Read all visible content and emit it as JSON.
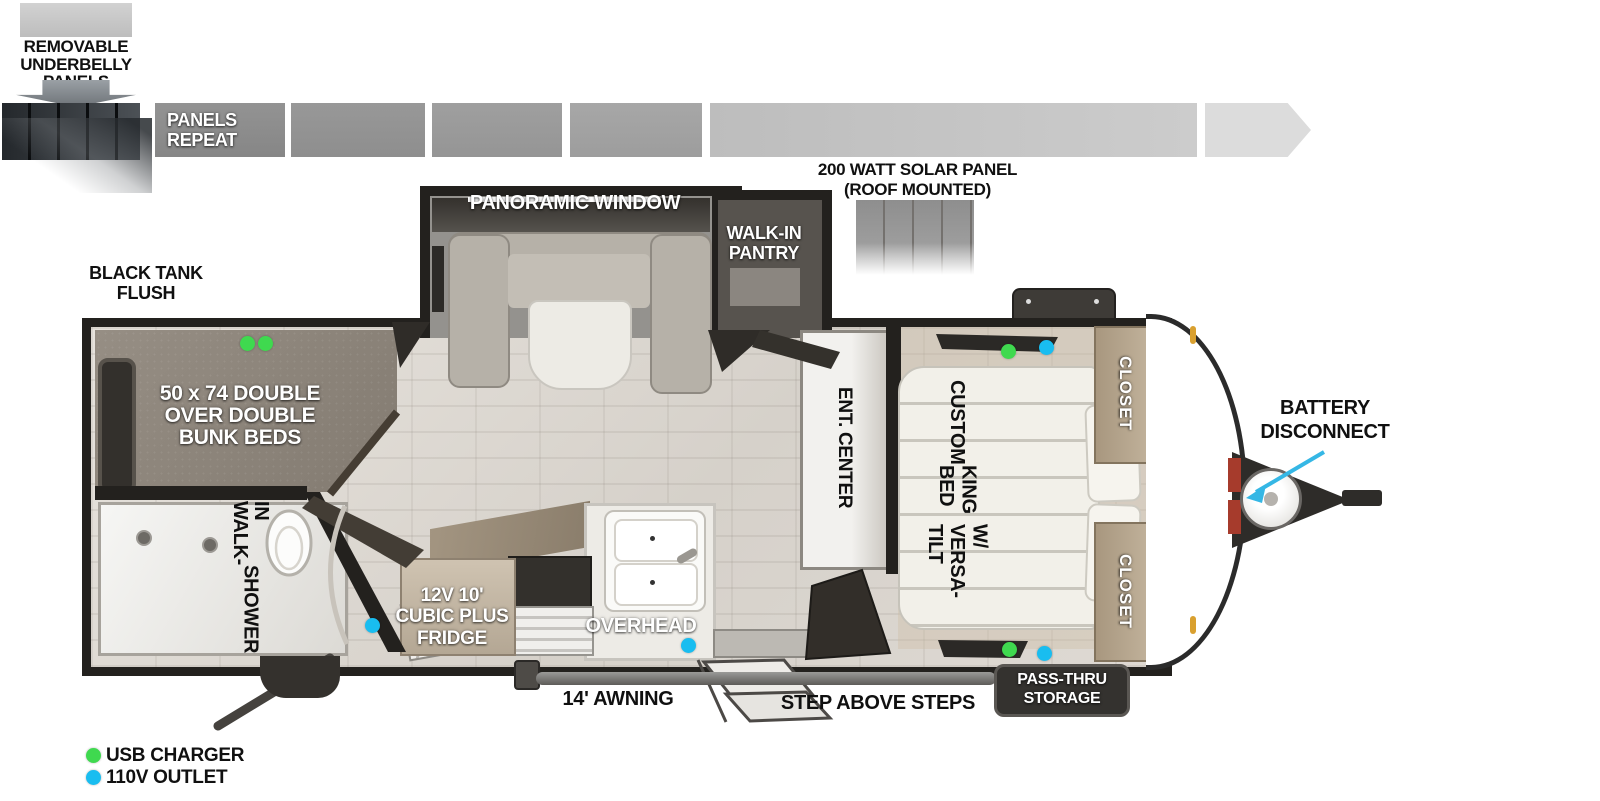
{
  "colors": {
    "usb_green": "#3fd94f",
    "outlet_blue": "#19bdf0",
    "arrow_cyan": "#35b7e5"
  },
  "underbelly": {
    "lines": [
      "REMOVABLE",
      "UNDERBELLY",
      "PANELS"
    ]
  },
  "panel_strip": {
    "repeat_label_lines": [
      "PANELS",
      "REPEAT"
    ]
  },
  "solar": {
    "lines": [
      "200 WATT SOLAR PANEL",
      "(ROOF MOUNTED)"
    ]
  },
  "exterior": {
    "black_tank_flush": [
      "BLACK TANK",
      "FLUSH"
    ],
    "battery_disconnect": [
      "BATTERY",
      "DISCONNECT"
    ],
    "awning": "14' AWNING",
    "steps": "STEP ABOVE STEPS",
    "pass_thru": [
      "PASS-THRU",
      "STORAGE"
    ]
  },
  "rooms": {
    "panoramic_window": "PANORAMIC WINDOW",
    "walk_in_pantry": [
      "WALK-IN",
      "PANTRY"
    ],
    "bunks": [
      "50 x 74 DOUBLE",
      "OVER DOUBLE",
      "BUNK BEDS"
    ],
    "shower": [
      "WALK-IN",
      "SHOWER"
    ],
    "fridge": [
      "12V 10'",
      "CUBIC PLUS",
      "FRIDGE"
    ],
    "overhead": "OVERHEAD",
    "ent_center": "ENT. CENTER",
    "king_bed": [
      "CUSTOM",
      "KING BED",
      "W/ VERSA-TILT"
    ],
    "closet_top": "CLOSET",
    "closet_bottom": "CLOSET"
  },
  "legend": [
    {
      "label": "USB CHARGER"
    },
    {
      "label": "110V OUTLET"
    }
  ]
}
